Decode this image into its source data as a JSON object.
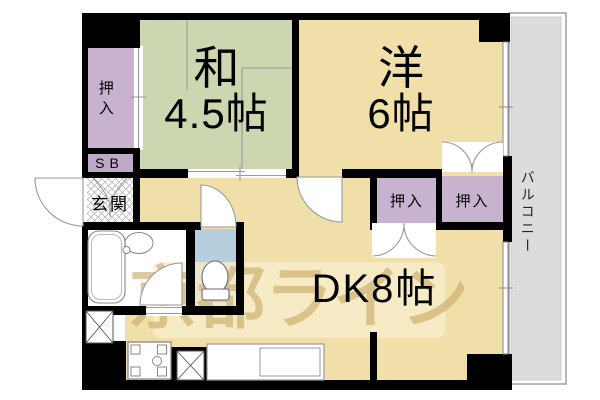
{
  "floorplan": {
    "rooms": {
      "washitsu": {
        "name": "和",
        "size": "4.5帖"
      },
      "youshitsu": {
        "name": "洋",
        "size": "6帖"
      },
      "dk": {
        "label": "DK8帖"
      },
      "oshiire_left": {
        "label": "押入"
      },
      "oshiire_dk": {
        "label": "押入"
      },
      "oshiire_youshitsu": {
        "label": "押入"
      },
      "shoe_box": {
        "label": "SB"
      },
      "genkan": {
        "label": "玄関"
      },
      "balcony": {
        "label": "バルコニー"
      }
    },
    "watermark": {
      "text": "京都ライン"
    },
    "colors": {
      "wall": "#000000",
      "tatami_room": "#ccd7b1",
      "flooring": "#f0dfa9",
      "closet": "#c7b3cf",
      "shoe_box": "#bfa9c9",
      "toilet_room": "#b7cedf",
      "balcony": "#dcdcdc",
      "genkan_hatch": "#adadad",
      "watermark_text": "#c9a766",
      "watermark_band": "#f8eecb",
      "fixture_line": "#888888"
    }
  }
}
